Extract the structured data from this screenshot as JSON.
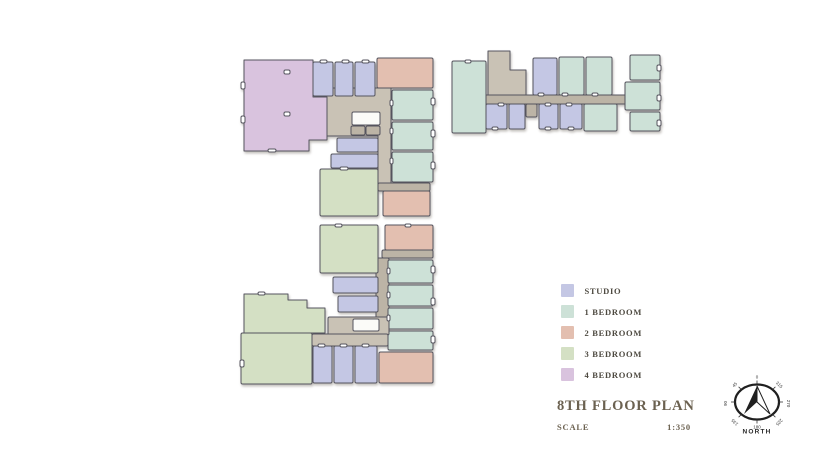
{
  "title_block": {
    "title": "8TH FLOOR PLAN",
    "scale_label": "SCALE",
    "scale_value": "1:350"
  },
  "legend": {
    "items": [
      {
        "key": "studio",
        "label": "STUDIO",
        "color": "#c4c7e4"
      },
      {
        "key": "one_bed",
        "label": "1 BEDROOM",
        "color": "#cde1d7"
      },
      {
        "key": "two_bed",
        "label": "2 BEDROOM",
        "color": "#e3bfb0"
      },
      {
        "key": "three_bed",
        "label": "3 BEDROOM",
        "color": "#d4e0c4"
      },
      {
        "key": "four_bed",
        "label": "4 BEDROOM",
        "color": "#d9c3de"
      }
    ]
  },
  "compass": {
    "label": "NORTH",
    "degrees": [
      "0",
      "45",
      "90",
      "135",
      "180",
      "225",
      "270",
      "315"
    ]
  },
  "theme": {
    "background": "#ffffff",
    "core": "#c9c2b5",
    "core_dark": "#bcb4a6",
    "outline": "#55545e",
    "title_text": "#6b6150",
    "compass_ink": "#1f1f1f"
  }
}
